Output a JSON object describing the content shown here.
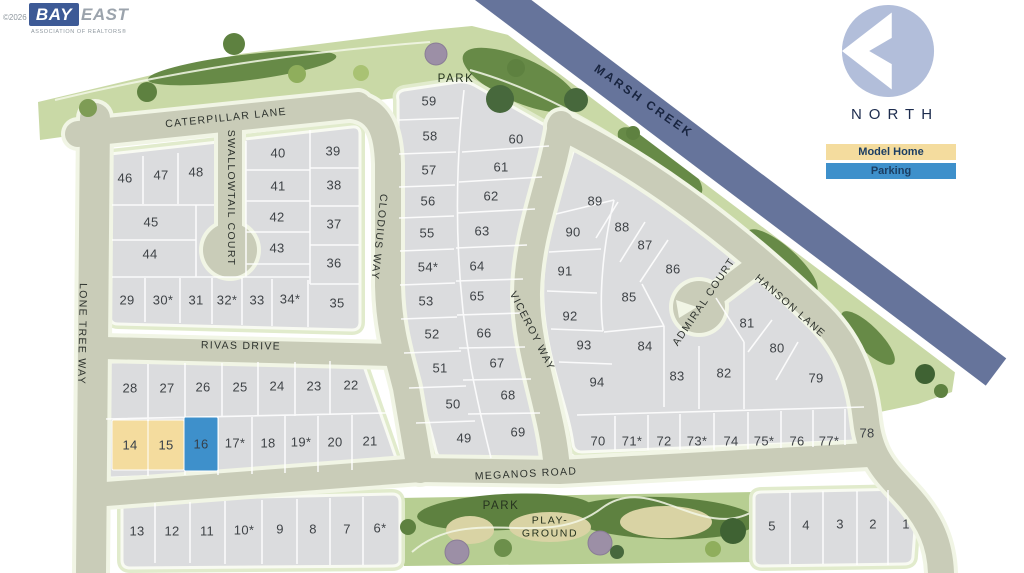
{
  "branding": {
    "copyright": "©2026",
    "logo_primary": "BAY",
    "logo_secondary": "EAST",
    "tagline": "ASSOCIATION OF REALTORS®"
  },
  "compass": {
    "label": "NORTH"
  },
  "legend": {
    "model_home": {
      "label": "Model Home",
      "color": "#F4DC9E"
    },
    "parking": {
      "label": "Parking",
      "color": "#3E90CB"
    }
  },
  "map": {
    "waterway_label": "MARSH CREEK",
    "park_label_top": "PARK",
    "park_label_bottom": "PARK",
    "playground_label": "PLAY-\nGROUND",
    "streets": {
      "caterpillar": "CATERPILLAR LANE",
      "swallowtail": "SWALLOWTAIL COURT",
      "lone_tree": "LONE TREE WAY",
      "clodius": "CLODIUS WAY",
      "rivas": "RIVAS DRIVE",
      "viceroy": "VICEROY WAY",
      "admiral": "ADMIRAL COURT",
      "hanson": "HANSON LANE",
      "meganos": "MEGANOS ROAD"
    },
    "lots": [
      {
        "label": "1",
        "x": 906,
        "y": 524
      },
      {
        "label": "2",
        "x": 873,
        "y": 524
      },
      {
        "label": "3",
        "x": 840,
        "y": 524
      },
      {
        "label": "4",
        "x": 806,
        "y": 525
      },
      {
        "label": "5",
        "x": 772,
        "y": 526
      },
      {
        "label": "6*",
        "x": 380,
        "y": 528
      },
      {
        "label": "7",
        "x": 347,
        "y": 529
      },
      {
        "label": "8",
        "x": 313,
        "y": 529
      },
      {
        "label": "9",
        "x": 280,
        "y": 529
      },
      {
        "label": "10*",
        "x": 244,
        "y": 530
      },
      {
        "label": "11",
        "x": 207,
        "y": 531
      },
      {
        "label": "12",
        "x": 172,
        "y": 531
      },
      {
        "label": "13",
        "x": 137,
        "y": 531
      },
      {
        "label": "14",
        "x": 130,
        "y": 445,
        "highlight": "model-home"
      },
      {
        "label": "15",
        "x": 166,
        "y": 445,
        "highlight": "model-home"
      },
      {
        "label": "16",
        "x": 201,
        "y": 444,
        "highlight": "parking"
      },
      {
        "label": "17*",
        "x": 235,
        "y": 443
      },
      {
        "label": "18",
        "x": 268,
        "y": 443
      },
      {
        "label": "19*",
        "x": 301,
        "y": 442
      },
      {
        "label": "20",
        "x": 335,
        "y": 442
      },
      {
        "label": "21",
        "x": 370,
        "y": 441
      },
      {
        "label": "22",
        "x": 351,
        "y": 385
      },
      {
        "label": "23",
        "x": 314,
        "y": 386
      },
      {
        "label": "24",
        "x": 277,
        "y": 386
      },
      {
        "label": "25",
        "x": 240,
        "y": 387
      },
      {
        "label": "26",
        "x": 203,
        "y": 387
      },
      {
        "label": "27",
        "x": 167,
        "y": 388
      },
      {
        "label": "28",
        "x": 130,
        "y": 388
      },
      {
        "label": "29",
        "x": 127,
        "y": 300
      },
      {
        "label": "30*",
        "x": 163,
        "y": 300
      },
      {
        "label": "31",
        "x": 196,
        "y": 300
      },
      {
        "label": "32*",
        "x": 227,
        "y": 300
      },
      {
        "label": "33",
        "x": 257,
        "y": 300
      },
      {
        "label": "34*",
        "x": 290,
        "y": 299
      },
      {
        "label": "35",
        "x": 337,
        "y": 303
      },
      {
        "label": "36",
        "x": 334,
        "y": 263
      },
      {
        "label": "37",
        "x": 334,
        "y": 224
      },
      {
        "label": "38",
        "x": 334,
        "y": 185
      },
      {
        "label": "39",
        "x": 333,
        "y": 151
      },
      {
        "label": "40",
        "x": 278,
        "y": 153
      },
      {
        "label": "41",
        "x": 278,
        "y": 186
      },
      {
        "label": "42",
        "x": 277,
        "y": 217
      },
      {
        "label": "43",
        "x": 277,
        "y": 248
      },
      {
        "label": "44",
        "x": 150,
        "y": 254
      },
      {
        "label": "45",
        "x": 151,
        "y": 222
      },
      {
        "label": "46",
        "x": 125,
        "y": 178
      },
      {
        "label": "47",
        "x": 161,
        "y": 175
      },
      {
        "label": "48",
        "x": 196,
        "y": 172
      },
      {
        "label": "49",
        "x": 464,
        "y": 438
      },
      {
        "label": "50",
        "x": 453,
        "y": 404
      },
      {
        "label": "51",
        "x": 440,
        "y": 368
      },
      {
        "label": "52",
        "x": 432,
        "y": 334
      },
      {
        "label": "53",
        "x": 426,
        "y": 301
      },
      {
        "label": "54*",
        "x": 428,
        "y": 267
      },
      {
        "label": "55",
        "x": 427,
        "y": 233
      },
      {
        "label": "56",
        "x": 428,
        "y": 201
      },
      {
        "label": "57",
        "x": 429,
        "y": 170
      },
      {
        "label": "58",
        "x": 430,
        "y": 136
      },
      {
        "label": "59",
        "x": 429,
        "y": 101
      },
      {
        "label": "60",
        "x": 516,
        "y": 139
      },
      {
        "label": "61",
        "x": 501,
        "y": 167
      },
      {
        "label": "62",
        "x": 491,
        "y": 196
      },
      {
        "label": "63",
        "x": 482,
        "y": 231
      },
      {
        "label": "64",
        "x": 477,
        "y": 266
      },
      {
        "label": "65",
        "x": 477,
        "y": 296
      },
      {
        "label": "66",
        "x": 484,
        "y": 333
      },
      {
        "label": "67",
        "x": 497,
        "y": 363
      },
      {
        "label": "68",
        "x": 508,
        "y": 395
      },
      {
        "label": "69",
        "x": 518,
        "y": 432
      },
      {
        "label": "70",
        "x": 598,
        "y": 441
      },
      {
        "label": "71*",
        "x": 632,
        "y": 441
      },
      {
        "label": "72",
        "x": 664,
        "y": 441
      },
      {
        "label": "73*",
        "x": 697,
        "y": 441
      },
      {
        "label": "74",
        "x": 731,
        "y": 441
      },
      {
        "label": "75*",
        "x": 764,
        "y": 441
      },
      {
        "label": "76",
        "x": 797,
        "y": 441
      },
      {
        "label": "77*",
        "x": 829,
        "y": 441
      },
      {
        "label": "78",
        "x": 867,
        "y": 433
      },
      {
        "label": "79",
        "x": 816,
        "y": 378
      },
      {
        "label": "80",
        "x": 777,
        "y": 348
      },
      {
        "label": "81",
        "x": 747,
        "y": 323
      },
      {
        "label": "82",
        "x": 724,
        "y": 373
      },
      {
        "label": "83",
        "x": 677,
        "y": 376
      },
      {
        "label": "84",
        "x": 645,
        "y": 346
      },
      {
        "label": "85",
        "x": 629,
        "y": 297
      },
      {
        "label": "86",
        "x": 673,
        "y": 269
      },
      {
        "label": "87",
        "x": 645,
        "y": 245
      },
      {
        "label": "88",
        "x": 622,
        "y": 227
      },
      {
        "label": "89",
        "x": 595,
        "y": 201
      },
      {
        "label": "90",
        "x": 573,
        "y": 232
      },
      {
        "label": "91",
        "x": 565,
        "y": 271
      },
      {
        "label": "92",
        "x": 570,
        "y": 316
      },
      {
        "label": "93",
        "x": 584,
        "y": 345
      },
      {
        "label": "94",
        "x": 597,
        "y": 382
      }
    ]
  }
}
